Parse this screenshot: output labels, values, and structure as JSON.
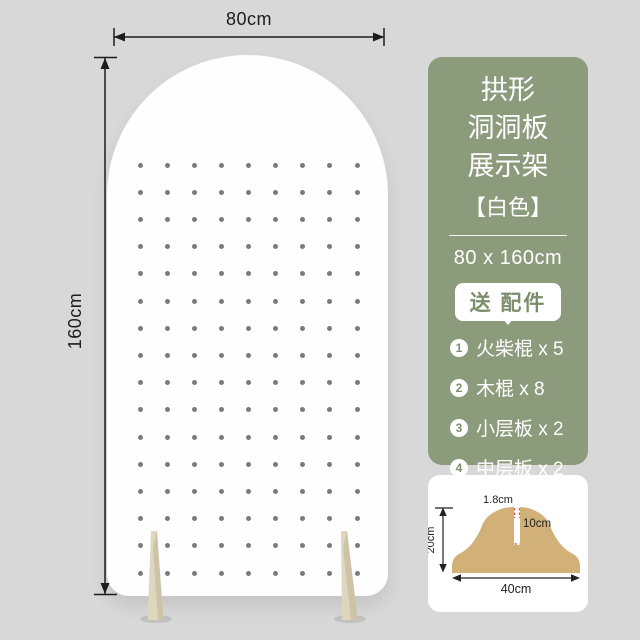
{
  "page": {
    "background_color": "#d8d8d8"
  },
  "board": {
    "width_label": "80cm",
    "height_label": "160cm",
    "color": "#fefefe",
    "hole_color": "#7b7b7b",
    "grid": {
      "rows": 16,
      "cols": 9
    },
    "feet_color": "#ded6bd"
  },
  "info_card": {
    "background_color": "#8d9b7d",
    "text_color": "#ffffff",
    "accent_text_color": "#7d8e6b",
    "title_lines": [
      "拱形",
      "洞洞板",
      "展示架"
    ],
    "color_tag": "【白色】",
    "size_text": "80 x 160cm",
    "gift_label": "送 配件",
    "accessories": [
      {
        "num": "1",
        "label": "火柴棍 x 5"
      },
      {
        "num": "2",
        "label": "木棍 x 8"
      },
      {
        "num": "3",
        "label": "小层板 x 2"
      },
      {
        "num": "4",
        "label": "中层板 x 2"
      }
    ]
  },
  "base_diagram": {
    "wood_color": "#d2b179",
    "slot_mark_color": "#e2574c",
    "slot_width_label": "1.8cm",
    "slot_depth_label": "10cm",
    "height_label": "20cm",
    "width_label": "40cm"
  }
}
